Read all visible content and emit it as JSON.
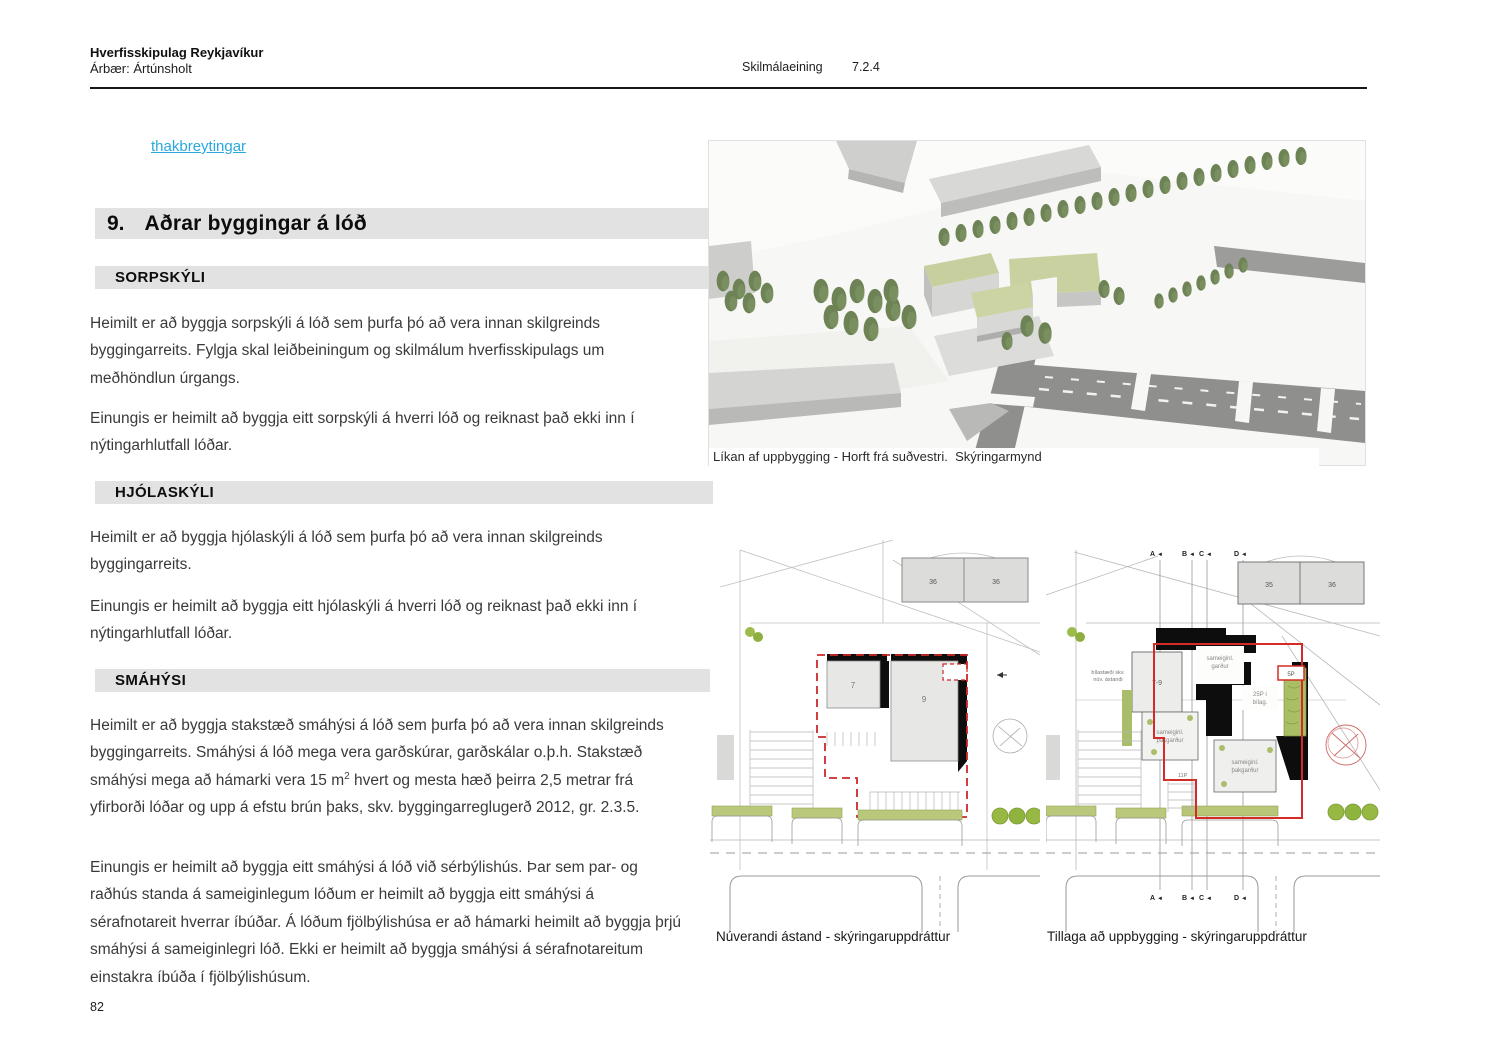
{
  "header": {
    "org": "Hverfisskipulag Reykjavíkur",
    "district": "Árbær: Ártúnsholt",
    "meta_label": "Skilmálaeining",
    "meta_value": "7.2.4"
  },
  "intro_link": "thakbreytingar",
  "section": {
    "number": "9.",
    "title": "Aðrar byggingar á lóð"
  },
  "sorpskyli": {
    "heading": "SORPSKÝLI",
    "p1": "Heimilt er að byggja sorpskýli á lóð sem þurfa þó að vera innan skilgreinds byggingarreits. Fylgja skal leiðbeiningum og skilmálum hverfisskipulags um meðhöndlun úrgangs.",
    "p2": "Einungis er heimilt að byggja eitt sorpskýli á hverri lóð og reiknast það ekki inn í nýtingarhlutfall lóðar."
  },
  "hjolaskyli": {
    "heading": "HJÓLASKÝLI",
    "p1": "Heimilt er að byggja hjólaskýli á lóð sem þurfa þó að vera innan skilgreinds byggingarreits.",
    "p2": "Einungis er heimilt að byggja eitt hjólaskýli á hverri lóð og reiknast það ekki inn í nýtingarhlutfall lóðar."
  },
  "smahysi": {
    "heading": "SMÁHÝSI",
    "p1a": "Heimilt er að byggja stakstæð smáhýsi á lóð sem þurfa þó að vera innan skilgreinds byggingarreits. Smáhýsi á lóð mega vera garðskúrar, garðskálar o.þ.h. Stakstæð smáhýsi mega að hámarki vera 15 m",
    "p1_sup": "2",
    "p1b": " hvert og mesta hæð þeirra 2,5 metrar frá yfirborði lóðar og upp á efstu brún þaks, skv. byggingarreglugerð 2012, gr. 2.3.5.",
    "p2": "Einungis er heimilt að byggja eitt smáhýsi á lóð við sérbýlishús. Þar sem par- og raðhús standa á sameiginlegum lóðum er heimilt að byggja eitt smáhýsi á sérafnotareit hverrar íbúðar. Á lóðum fjölbýlishúsa er að hámarki heimilt að byggja þrjú smáhýsi á sameiginlegri lóð. Ekki er heimilt að byggja smáhýsi á sérafnotareitum einstakra íbúða í fjölbýlishúsum."
  },
  "figures": {
    "model": {
      "caption": "Líkan af uppbygging - Horft frá suðvestri.  Skýringarmynd"
    },
    "current": {
      "caption": "Núverandi ástand - skýringaruppdráttur",
      "bldg_top_left": "36",
      "bldg_top_right": "36",
      "bldg_left": "7",
      "bldg_right": "9"
    },
    "proposal": {
      "caption": "Tillaga að uppbygging - skýringaruppdráttur",
      "marker_a": "A",
      "marker_b": "B",
      "marker_c": "C",
      "marker_d": "D",
      "bldg_top_left": "35",
      "bldg_top_right": "36",
      "bldg_main": "7-9",
      "lbl_garden_1": "sameiginl.",
      "lbl_garden_2": "garður",
      "lbl_pdeck_1": "25P í",
      "lbl_pdeck_2": "bílag.",
      "lbl_roof1_1": "sameiginl.",
      "lbl_roof1_2": "þakgarður",
      "lbl_roof2_1": "sameiginl.",
      "lbl_roof2_2": "þakgarður",
      "lbl_5p": "5P",
      "lbl_11p": "11P",
      "note_1": "bílastæði skv.",
      "note_2": "núv. ástandi"
    }
  },
  "page_number": "82",
  "colors": {
    "link_blue": "#29a9e0",
    "boundary_red": "#cc2a2a",
    "roof_green": "#c9d1a0",
    "tree_green": "#6d8355",
    "heading_bg": "#e2e2e2"
  }
}
